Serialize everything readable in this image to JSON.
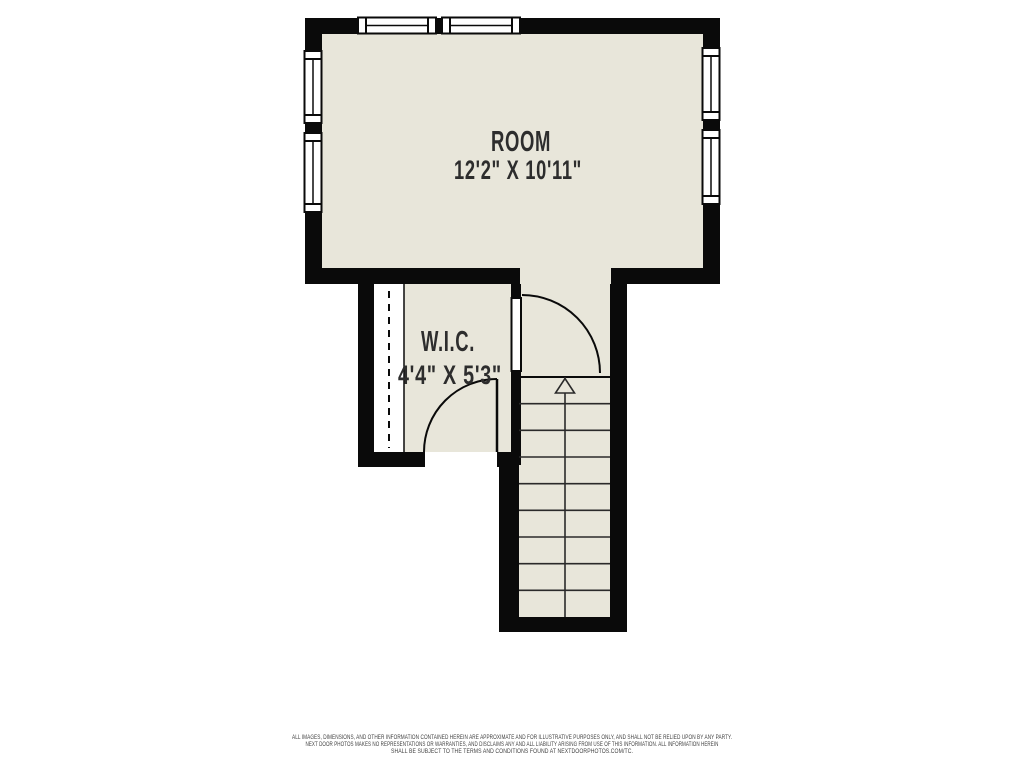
{
  "rooms": [
    {
      "name": "ROOM",
      "dimensions": "12'2\" X 10'11\""
    },
    {
      "name": "W.I.C.",
      "dimensions": "4'4\" X 5'3\""
    }
  ],
  "stairs": {
    "direction": "up",
    "tread_count": 9
  },
  "icons": {
    "window": "double-pane-window",
    "door": "quarter-arc-door-swing",
    "stairs_arrow": "up-arrow",
    "closet_rod": "dashed-line"
  },
  "colors": {
    "wall": "#0a0a0a",
    "floor": "#e8e6da",
    "background": "#ffffff",
    "label_text": "#2d2d2d",
    "tread_line": "#2a2a2a",
    "disclaimer_text": "#3f3f3f"
  },
  "disclaimer": {
    "line1": "ALL IMAGES, DIMENSIONS, AND OTHER INFORMATION CONTAINED HEREIN ARE APPROXIMATE AND FOR ILLUSTRATIVE PURPOSES ONLY, AND SHALL NOT BE RELIED UPON BY ANY PARTY.",
    "line2": "NEXT DOOR PHOTOS MAKES NO REPRESENTATIONS OR WARRANTIES, AND DISCLAIMS ANY AND ALL LIABILITY ARISING FROM USE OF THIS INFORMATION. ALL INFORMATION HEREIN",
    "line3": "SHALL BE SUBJECT TO THE TERMS AND CONDITIONS FOUND AT NEXTDOORPHOTOS.COM/TC."
  }
}
